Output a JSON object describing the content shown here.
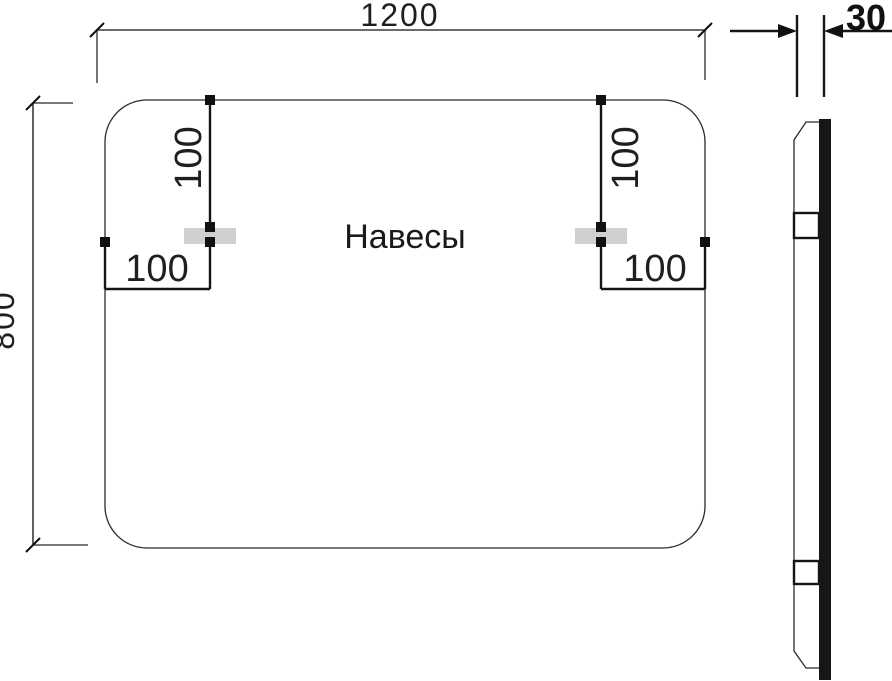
{
  "front_view": {
    "label": "Навесы",
    "width_dim": "1200",
    "height_dim": "800",
    "hangers": {
      "left": {
        "top_offset": "100",
        "side_offset": "100"
      },
      "right": {
        "top_offset": "100",
        "side_offset": "100"
      }
    }
  },
  "side_view": {
    "thickness_dim": "30"
  },
  "colors": {
    "line": "#2b2b2b",
    "marker": "#111111",
    "hanger_fill": "#cfcfcf",
    "glass_fill": "#161616",
    "text": "#1a1a1a"
  }
}
